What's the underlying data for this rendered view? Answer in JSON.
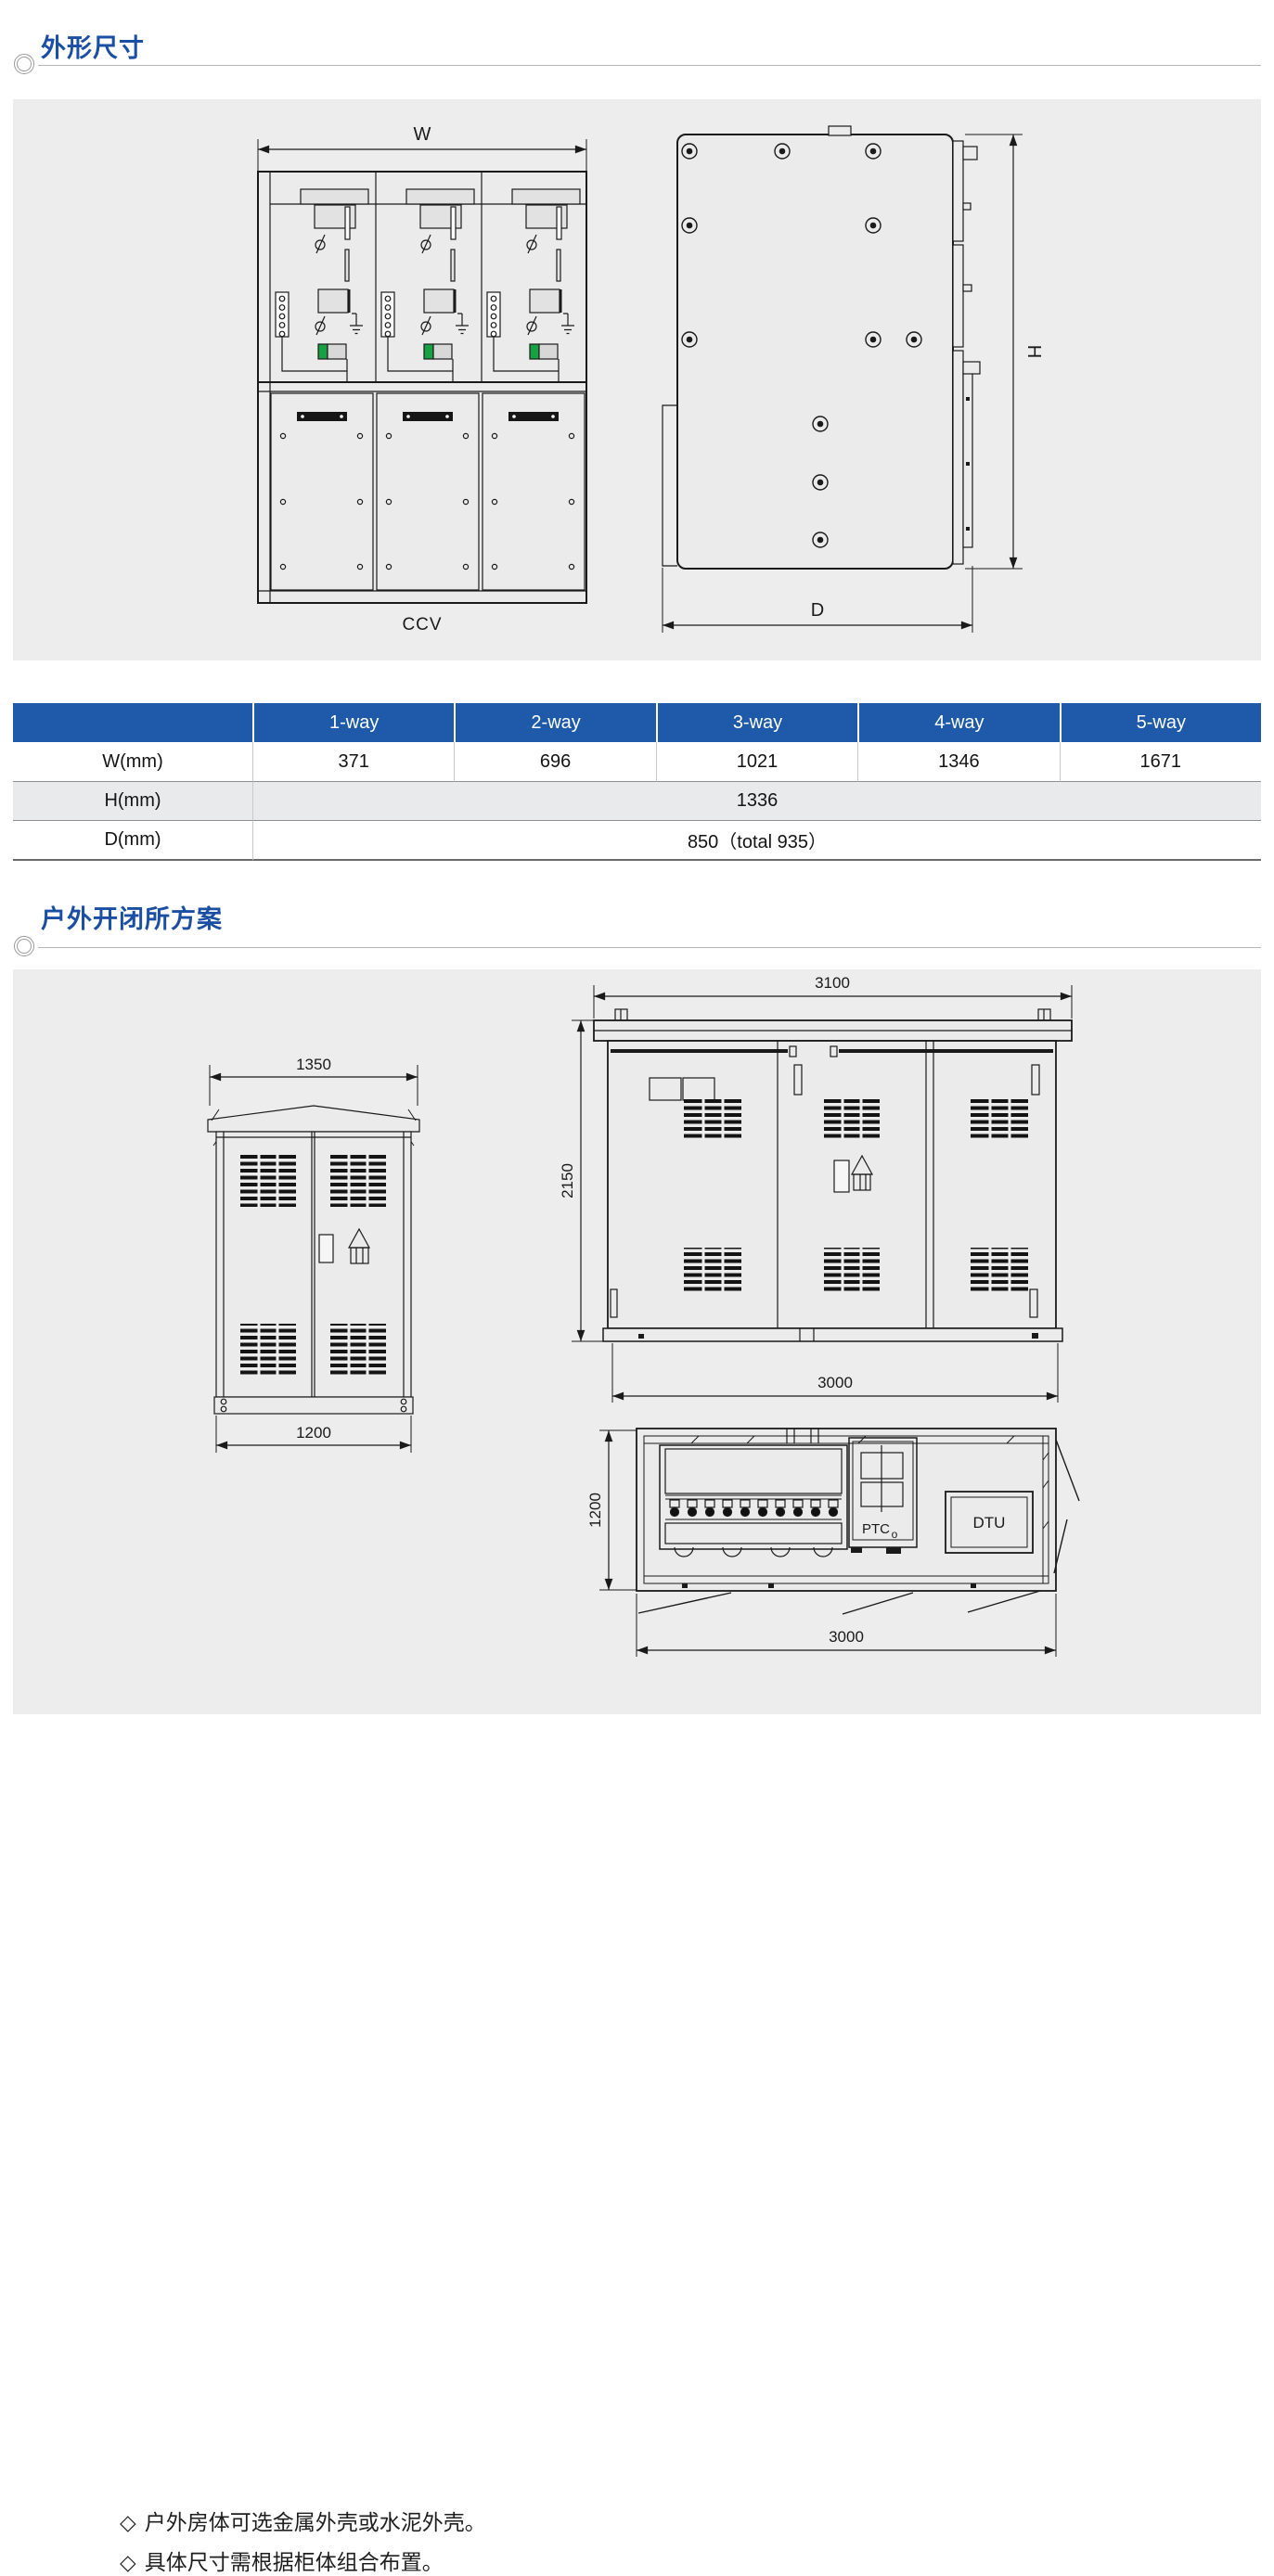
{
  "page": {
    "bg": "#ffffff",
    "panel_bg": "#ededee",
    "accent_blue": "#1b4fa3",
    "table_header_bg": "#1e5aa9",
    "indicator_green": "#18a045"
  },
  "section1": {
    "title": "外形尺寸"
  },
  "front_view": {
    "width_label": "W",
    "caption": "CCV"
  },
  "side_view": {
    "height_label": "H",
    "depth_label": "D"
  },
  "table": {
    "headers": [
      "",
      "1-way",
      "2-way",
      "3-way",
      "4-way",
      "5-way"
    ],
    "rows": [
      {
        "label": "W(mm)",
        "values": [
          "371",
          "696",
          "1021",
          "1346",
          "1671"
        ]
      },
      {
        "label": "H(mm)",
        "merged_value": "1336"
      },
      {
        "label": "D(mm)",
        "merged_value": "850（total 935）"
      }
    ]
  },
  "section2": {
    "title": "户外开闭所方案"
  },
  "outdoor": {
    "small_cabinet": {
      "top_dim": "1350",
      "bottom_dim": "1200"
    },
    "large_front": {
      "top_dim": "3100",
      "height_dim": "2150",
      "bottom_dim": "3000"
    },
    "plan_view": {
      "depth_dim": "1200",
      "bottom_dim": "3000",
      "ptc_label": "PTC",
      "ptc_subscript": "o",
      "dtu_label": "DTU"
    },
    "notes": [
      {
        "bullet": "◇",
        "text": "户外房体可选金属外壳或水泥外壳。"
      },
      {
        "bullet": "◇",
        "text": "具体尺寸需根据柜体组合布置。"
      }
    ]
  }
}
